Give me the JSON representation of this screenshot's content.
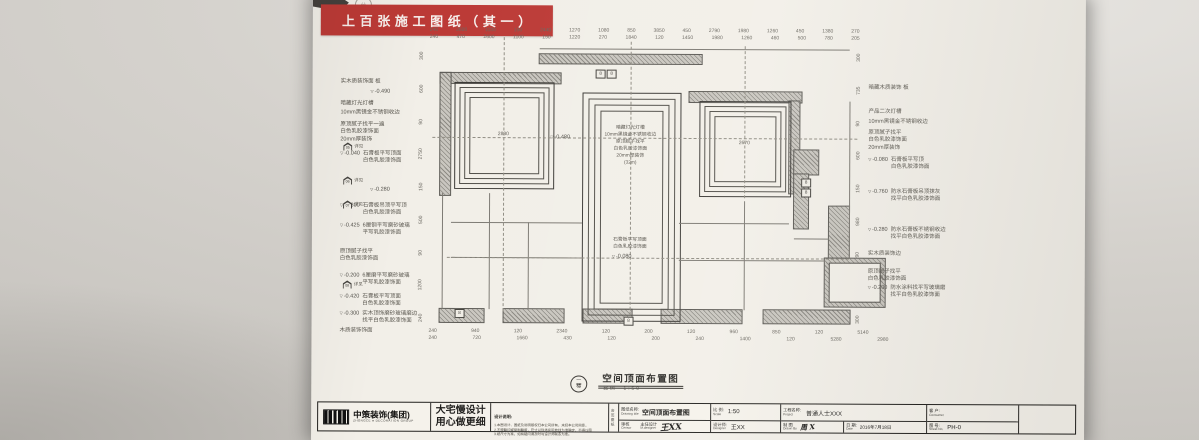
{
  "photo": {
    "banner_text": "上 百 张 施 工 图 纸 （ 其 一 ）",
    "banner_color": "#bc3a36",
    "stamp_glyph": "分"
  },
  "plan": {
    "floor_circle": {
      "top": "一",
      "bottom": "楼"
    },
    "title": "空间顶面布置图",
    "scale_label": "比例",
    "scale_value": "1:50",
    "room_a_dim": "2830",
    "room_c_dim": "2670",
    "room_b_elev": "-0.480",
    "room_b_top_text": "暗藏灯光灯槽\n10mm黑镜金不锈钢收边\n原顶腻子找平\n白色乳胶漆饰面\n20mm厚装饰\n(32m)",
    "room_b_bottom_text": "石膏板平写顶面\n白色乳胶漆饰面",
    "room_b_bottom_elev": "-0.080",
    "fixture_label": "8",
    "detail_markers": [
      {
        "num": "05",
        "label": "详见"
      },
      {
        "num": "06",
        "label": "详见"
      },
      {
        "num": "07",
        "label": "详见"
      },
      {
        "num": "08",
        "label": "详见"
      }
    ],
    "left_annotations": [
      {
        "t": "实木质装饰面 板"
      },
      {
        "e": "-0.490"
      },
      {
        "t": "暗藏灯光灯槽"
      },
      {
        "t": "10mm黑镜金不锈钢收边"
      },
      {
        "t": "原顶腻子找平一遍\n白色乳胶漆饰面"
      },
      {
        "t": "20mm厚装饰"
      },
      {
        "e": "-0.040",
        "t": "石膏板平写顶面\n白色乳胶漆饰面"
      },
      {
        "e": "-0.280"
      },
      {
        "e": "-0.300",
        "t": "石膏板吊顶平写顶\n白色乳胶漆饰面"
      },
      {
        "e": "-0.425",
        "t": "6厘钢平写磨砂玻璃\n平写乳胶漆饰面"
      },
      {
        "t": "原顶腻子找平\n白色乳胶漆饰面"
      },
      {
        "e": "-0.200",
        "t": "6厘磨平写磨砂玻璃\n平写乳胶漆饰面"
      },
      {
        "e": "-0.420",
        "t": "石膏板平写顶面\n白色乳胶漆饰面"
      },
      {
        "e": "-0.300",
        "t": "实木顶饰磨砂玻璃磨边\n找平白色乳胶漆饰面"
      },
      {
        "t": "木质装饰饰面"
      }
    ],
    "right_annotations": [
      {
        "t": "暗藏木质装饰 板"
      },
      {
        "t": "产品二次灯槽"
      },
      {
        "t": "10mm黑镜金不锈钢收边"
      },
      {
        "t": "原顶腻子找平\n白色乳胶漆饰面"
      },
      {
        "t": "20mm厚装饰"
      },
      {
        "e": "-0.080",
        "t": "石膏板平写顶\n白色乳胶漆饰面"
      },
      {
        "e": "-0.760",
        "t": "防水石膏板吊顶抹灰\n找平白色乳胶漆饰面"
      },
      {
        "e": "-0.280",
        "t": "防水石膏板不锈钢收边\n找平白色乳胶漆饰面"
      },
      {
        "t": "实木质装饰边"
      },
      {
        "t": "原顶腻子找平\n白色乳胶漆饰面"
      },
      {
        "e": "-0.200",
        "t": "防水涂料找平写玻璃磨\n找平白色乳胶漆饰面"
      }
    ],
    "dims": {
      "top1": [
        "240",
        "2600",
        "1100",
        "150",
        "2440",
        "1270",
        "1080",
        "850",
        "3850",
        "450",
        "2790",
        "1980",
        "1260",
        "450",
        "1380",
        "270"
      ],
      "top2": [
        "240",
        "470",
        "2600",
        "1100",
        "150",
        "1220",
        "270",
        "1840",
        "120",
        "1450",
        "1980",
        "1260",
        "460",
        "500",
        "780",
        "205"
      ],
      "bottom1": [
        "240",
        "940",
        "120",
        "2340",
        "120",
        "200",
        "120",
        "960",
        "850",
        "120",
        "5140"
      ],
      "bottom2": [
        "240",
        "720",
        "1660",
        "430",
        "120",
        "200",
        "240",
        "1400",
        "120",
        "5280",
        "2980"
      ],
      "left": [
        "300",
        "600",
        "90",
        "2750",
        "150",
        "500",
        "90",
        "1200",
        "240"
      ],
      "right": [
        "300",
        "735",
        "90",
        "600",
        "150",
        "980",
        "90",
        "760",
        "300"
      ]
    }
  },
  "title_block": {
    "logo": {
      "name": "中策装饰(集团)",
      "sub": "ZHONGCE ● DECORATION GROUP"
    },
    "slogan": {
      "line1": "大宅慢设计",
      "line2": "用心做更细"
    },
    "notes": {
      "title": "设计说明:",
      "lines": [
        "1.本图设计、图纸及说明版权归本公司所有，未经本公司同意，",
        "2.不得翻印或复制翻版，尺寸以现场实际放线为准确定，不得以图",
        "3.纸尺寸为准，如有疑问请及时与设计师联系为准。"
      ]
    },
    "sign_strip": "会签图纸",
    "drawing_title": {
      "label_cn": "图纸名称:",
      "label_en": "Drawing title",
      "value": "空间顶面布置图"
    },
    "censor": {
      "label_cn": "审核",
      "label_en": "Censor",
      "value": ""
    },
    "m_designer": {
      "label_cn": "主任设计",
      "label_en": "M.designer",
      "value": "王XX"
    },
    "scale": {
      "label_cn": "比 例:",
      "label_en": "Scale",
      "value": "1:50"
    },
    "designer": {
      "label_cn": "设计师:",
      "label_en": "Designer",
      "value": "王XX"
    },
    "project": {
      "label_cn": "工程名称:",
      "label_en": "Project",
      "value": "普通人士XXX"
    },
    "drawn_by": {
      "label_cn": "制 图",
      "label_en": "Drawn By",
      "value": "周 X"
    },
    "date": {
      "label_cn": "日 期:",
      "label_en": "Date",
      "value": "2016年7月18日"
    },
    "consumer": {
      "label_cn": "客 户:",
      "label_en": "Consumer",
      "value": ""
    },
    "sheet": {
      "label_cn": "图 号:",
      "label_en": "Sheet No.",
      "value": "PH-0"
    }
  }
}
